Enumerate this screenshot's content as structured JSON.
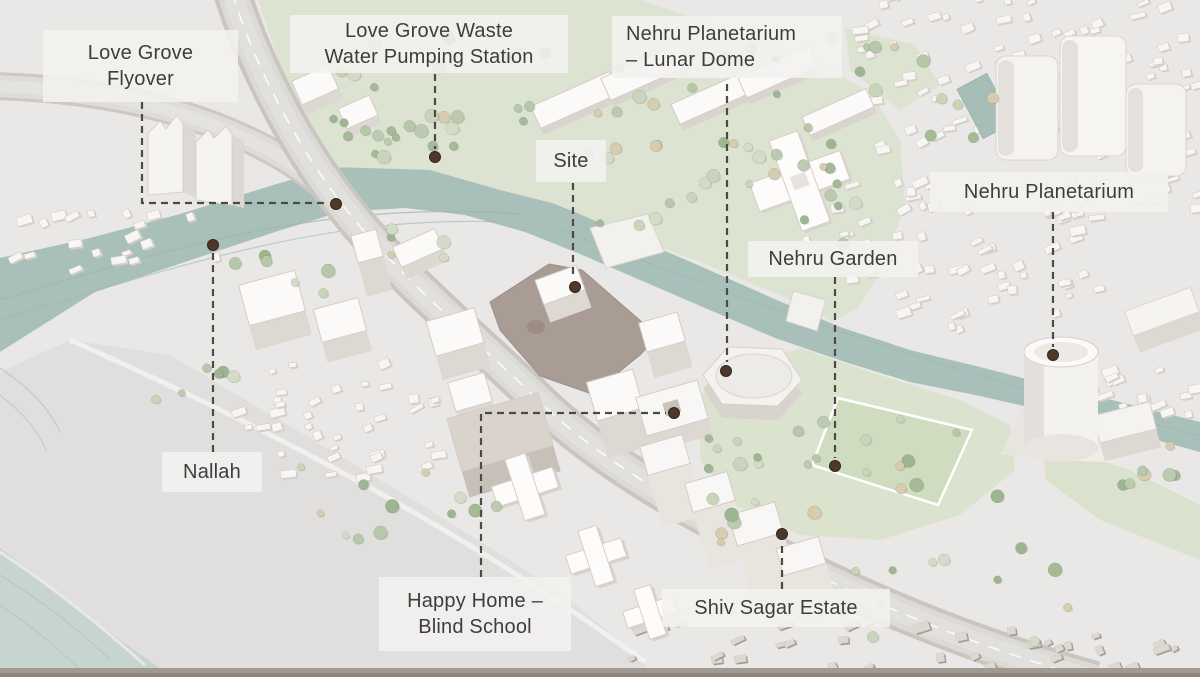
{
  "map": {
    "style": "axonometric-illustrated-site-plan",
    "colors": {
      "land": "#eae8e6",
      "beach": "#e0dfdd",
      "sea": "#c7d4cf",
      "canal_water": "#a9bfba",
      "park_green": "#dce3d1",
      "field_green": "#d0dcc0",
      "road": "#dbd9d5",
      "building_top": "#fbfaf8",
      "building_side": "#dcd7d1",
      "site_fill": "#a99c94",
      "leader_line": "#4c4a45",
      "marker_dot": "#4e382c",
      "label_text": "#3e3d3b",
      "label_background": "#f3f1ef"
    }
  },
  "annotations": [
    {
      "id": "love-grove-flyover",
      "lines": [
        "Love Grove",
        "Flyover"
      ],
      "box": {
        "x": 43,
        "y": 30,
        "w": 195,
        "h": 72
      },
      "align": "center",
      "leader": [
        [
          142,
          102
        ],
        [
          142,
          203
        ],
        [
          327,
          203
        ]
      ],
      "dot": [
        336,
        204
      ]
    },
    {
      "id": "love-grove-waste-water-pumping-station",
      "lines": [
        "Love Grove Waste",
        "Water Pumping Station"
      ],
      "box": {
        "x": 290,
        "y": 15,
        "w": 278,
        "h": 58
      },
      "align": "center",
      "leader": [
        [
          435,
          74
        ],
        [
          435,
          149
        ]
      ],
      "dot": [
        435,
        157
      ]
    },
    {
      "id": "nehru-planetarium-lunar-dome",
      "lines": [
        "Nehru Planetarium",
        "– Lunar Dome"
      ],
      "box": {
        "x": 612,
        "y": 16,
        "w": 230,
        "h": 62
      },
      "align": "left",
      "leader": [
        [
          727,
          84
        ],
        [
          727,
          362
        ]
      ],
      "dot": [
        726,
        371
      ]
    },
    {
      "id": "site",
      "lines": [
        "Site"
      ],
      "box": {
        "x": 536,
        "y": 140,
        "w": 70,
        "h": 42
      },
      "align": "center",
      "leader": [
        [
          573,
          183
        ],
        [
          573,
          279
        ]
      ],
      "dot": [
        575,
        287
      ]
    },
    {
      "id": "nehru-planetarium",
      "lines": [
        "Nehru Planetarium"
      ],
      "box": {
        "x": 930,
        "y": 172,
        "w": 238,
        "h": 40
      },
      "align": "center",
      "leader": [
        [
          1053,
          212
        ],
        [
          1053,
          347
        ]
      ],
      "dot": [
        1053,
        355
      ]
    },
    {
      "id": "nehru-garden",
      "lines": [
        "Nehru Garden"
      ],
      "box": {
        "x": 748,
        "y": 241,
        "w": 170,
        "h": 36
      },
      "align": "center",
      "leader": [
        [
          835,
          277
        ],
        [
          835,
          458
        ]
      ],
      "dot": [
        835,
        466
      ]
    },
    {
      "id": "nallah",
      "lines": [
        "Nallah"
      ],
      "box": {
        "x": 162,
        "y": 452,
        "w": 100,
        "h": 40
      },
      "align": "center",
      "leader": [
        [
          213,
          452
        ],
        [
          213,
          253
        ]
      ],
      "dot": [
        213,
        245
      ]
    },
    {
      "id": "happy-home-blind-school",
      "lines": [
        "Happy Home –",
        "Blind School"
      ],
      "box": {
        "x": 379,
        "y": 577,
        "w": 192,
        "h": 74
      },
      "align": "center",
      "leader": [
        [
          481,
          577
        ],
        [
          481,
          413
        ],
        [
          666,
          413
        ]
      ],
      "dot": [
        674,
        413
      ]
    },
    {
      "id": "shiv-sagar-estate",
      "lines": [
        "Shiv Sagar Estate"
      ],
      "box": {
        "x": 662,
        "y": 589,
        "w": 228,
        "h": 38
      },
      "align": "center",
      "leader": [
        [
          782,
          589
        ],
        [
          782,
          542
        ]
      ],
      "dot": [
        782,
        534
      ]
    }
  ]
}
